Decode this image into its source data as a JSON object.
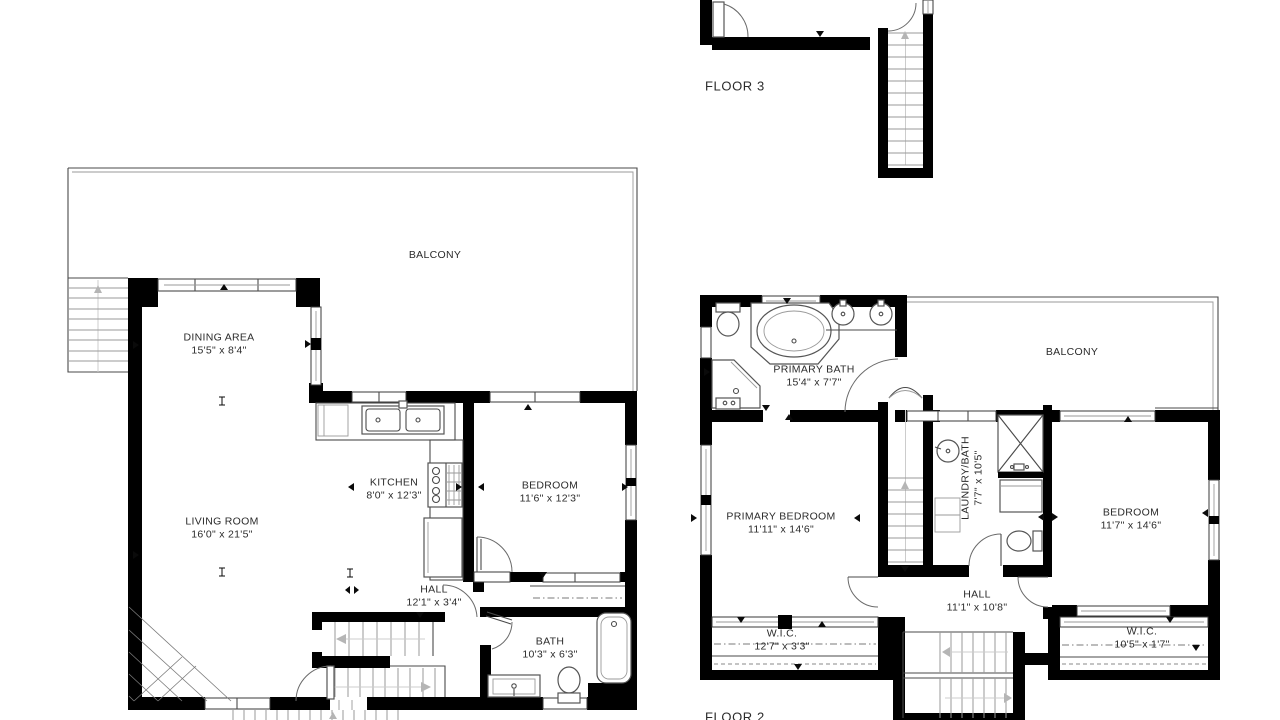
{
  "palette": {
    "wall": "#000000",
    "thin_line": "#4a4a4a",
    "light_line": "#9a9a9a",
    "text": "#2b2b2b",
    "background": "#ffffff"
  },
  "floor3": {
    "title": "FLOOR 3"
  },
  "floor1": {
    "balcony": {
      "label": "BALCONY"
    },
    "dining": {
      "name": "DINING AREA",
      "dims": "15'5\" x 8'4\""
    },
    "living": {
      "name": "LIVING ROOM",
      "dims": "16'0\" x 21'5\""
    },
    "kitchen": {
      "name": "KITCHEN",
      "dims": "8'0\" x 12'3\""
    },
    "bedroom": {
      "name": "BEDROOM",
      "dims": "11'6\" x 12'3\""
    },
    "hall": {
      "name": "HALL",
      "dims": "12'1\" x 3'4\""
    },
    "bath": {
      "name": "BATH",
      "dims": "10'3\" x 6'3\""
    }
  },
  "floor2": {
    "title": "FLOOR 2",
    "balcony": {
      "label": "BALCONY"
    },
    "primary_bath": {
      "name": "PRIMARY BATH",
      "dims": "15'4\" x 7'7\""
    },
    "primary_bedroom": {
      "name": "PRIMARY BEDROOM",
      "dims": "11'11\" x 14'6\""
    },
    "laundry_bath": {
      "name": "LAUNDRY/BATH",
      "dims": "7'7\" x 10'5\""
    },
    "bedroom": {
      "name": "BEDROOM",
      "dims": "11'7\" x 14'6\""
    },
    "hall": {
      "name": "HALL",
      "dims": "11'1\" x 10'8\""
    },
    "wic_left": {
      "name": "W.I.C.",
      "dims": "12'7\" x 3'3\""
    },
    "wic_right": {
      "name": "W.I.C.",
      "dims": "10'5\" x 1'7\""
    }
  }
}
